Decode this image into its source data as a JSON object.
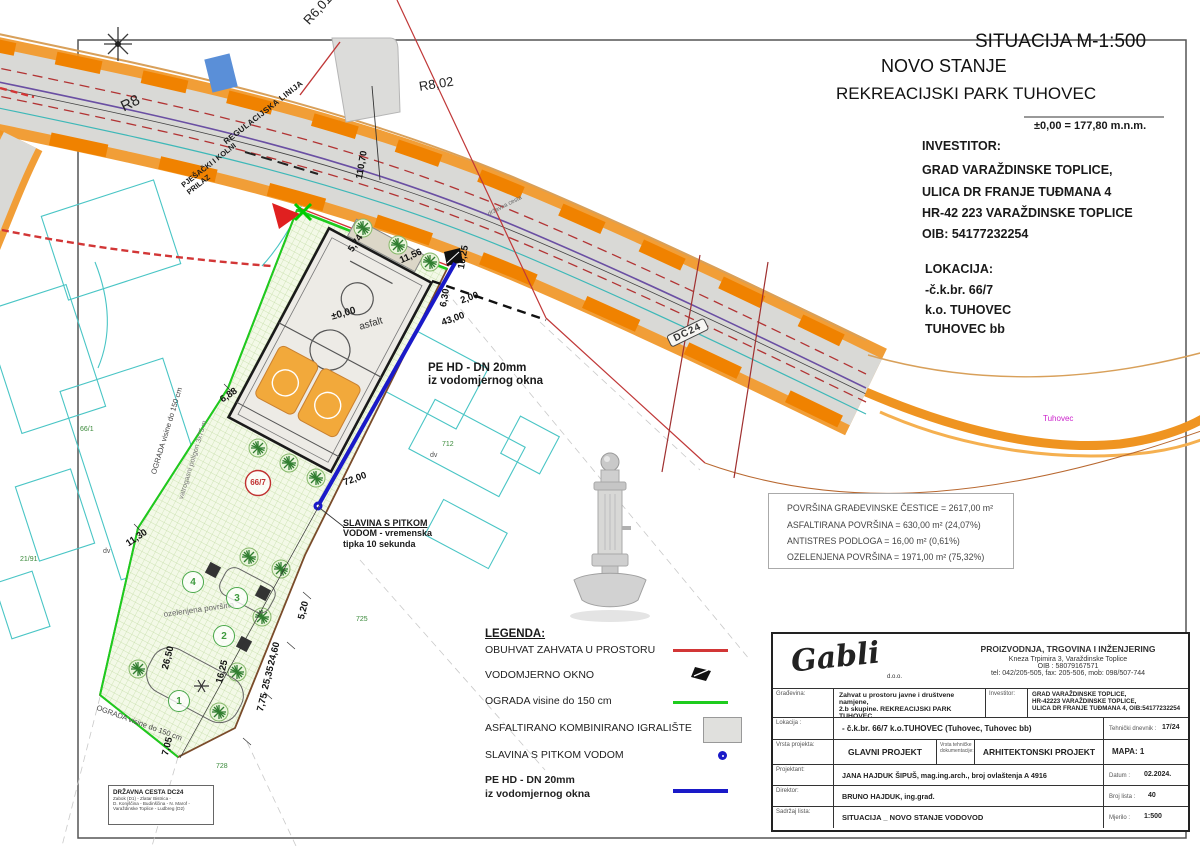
{
  "titles": {
    "situacija": "SITUACIJA  M-1:500",
    "novo_stanje": "NOVO STANJE",
    "park": "REKREACIJSKI PARK TUHOVEC",
    "elevation": "±0,00 = 177,80 m.n.m."
  },
  "investitor": {
    "label": "INVESTITOR:",
    "lines": [
      "GRAD VARAŽDINSKE TOPLICE,",
      "ULICA DR FRANJE TUĐMANA 4",
      " HR-42 223 VARAŽDINSKE TOPLICE",
      "OIB: 54177232254"
    ]
  },
  "lokacija": {
    "label": "LOKACIJA:",
    "lines": [
      "-č.k.br.  66/7",
      "k.o. TUHOVEC",
      "TUHOVEC bb"
    ]
  },
  "areas": {
    "lines": [
      "POVRŠINA GRAĐEVINSKE ČESTICE = 2617,00 m²",
      "ASFALTIRANA POVRŠINA = 630,00 m² (24,07%)",
      "ANTISTRES PODLOGA = 16,00 m² (0,61%)",
      "OZELENJENA POVRŠINA = 1971,00 m² (75,32%)"
    ]
  },
  "legend": {
    "title": "LEGENDA:",
    "items": [
      {
        "label": "OBUHVAT ZAHVATA U PROSTORU"
      },
      {
        "label": "VODOMJERNO OKNO"
      },
      {
        "label": "OGRADA visine do 150 cm"
      },
      {
        "label": "ASFALTIRANO KOMBINIRANO IGRALIŠTE"
      },
      {
        "label": "SLAVINA S PITKOM VODOM"
      },
      {
        "label": "PE HD - DN 20mm",
        "label2": "iz vodomjernog okna"
      }
    ]
  },
  "map": {
    "r8": "R8",
    "r601": "R6,01",
    "r802": "R8,02",
    "dc24_badge": "DC24",
    "tuhovec": "Tuhovec",
    "drzavna_cesta": "državna cesta",
    "regulacijska": "REGULACIJSKA LINIJA",
    "pjesacki": "PJEŠAČKI I KOLNI",
    "prilaz": "PRILAZ",
    "ograda_left": "OGRADA visine do 150 cm",
    "vatrogasni": "vatrogasni poligon 3x75 m",
    "ograda_bottom": "OGRADA visine do 150 cm",
    "ozelenjena": "ozelenjena površina",
    "zero": "±0,00",
    "asfalt": "asfalt",
    "pehd1": "PE HD - DN 20mm",
    "pehd2": "iz vodomjernog okna",
    "slavina1": "SLAVINA S PITKOM",
    "slavina2": "VODOM - vremenska",
    "slavina3": "tipka 10 sekunda",
    "parcel_main": "66/7",
    "zones": {
      "z1": "1",
      "z2": "2",
      "z3": "3",
      "z4": "4"
    },
    "parcels": {
      "p66_1": "66/1",
      "p21_91": "21/91",
      "p725": "725",
      "p712": "712",
      "p728": "728",
      "dv1": "dv",
      "dv2": "dv"
    },
    "dims": {
      "d110_70": "110,70",
      "d11_56": "11,56",
      "d5_74": "5,74",
      "d10_25": "10,25",
      "d6_30": "6,30",
      "d2_00": "2,00",
      "d43_00": "43,00",
      "d6_88": "6,88",
      "d11_30": "11,30",
      "d26_50": "26,50",
      "d16_25": "16,25",
      "d5_20": "5,20",
      "d24_60": "24,60",
      "d25_35": "25,35",
      "d7_75": "7,75",
      "d7_05": "7,05",
      "d72_00": "72,00"
    }
  },
  "roadbox": {
    "title": "DRŽAVNA CESTA DC24",
    "lines": [
      "Zabok (D1) - Zlatar Bistrica -",
      "D. Konjščina - Budinščina - N. Marof -",
      "Varaždinske Toplice - Ludbreg (D2)"
    ]
  },
  "titleblock": {
    "logo": "Gabli",
    "logo_suffix": "d.o.o.",
    "company": {
      "line1": "PROIZVODNJA, TRGOVINA I INŽENJERING",
      "line2": "Kneza Trpimira 3, Varaždinske Toplice",
      "line3": "OIB : 58079167571",
      "line4": "tel: 042/205-505, fax: 205-506, mob: 098/507-744"
    },
    "rows": {
      "gradevina_label": "Građevina:",
      "gradevina1": "Zahvat u prostoru javne i društvene namjene,",
      "gradevina2": "2.b skupine. REKREACIJSKI PARK TUHOVEC",
      "investitor_label": "Investitor:",
      "investitor1": "GRAD VARAŽDINSKE TOPLICE,",
      "investitor2": "HR-42223 VARAŽDINSKE TOPLICE,",
      "investitor3": "ULICA DR FRANJE TUĐMANA 4,  OIB:54177232254",
      "lokacija_label": "Lokacija :",
      "lokacija": "- č.k.br.  66/7  k.o.TUHOVEC (Tuhovec, Tuhovec bb)",
      "tehnicki_label": "Tehnički dnevnik :",
      "tehnicki": "17/24",
      "vrsta_label": "Vrsta projekta:",
      "vrsta": "GLAVNI PROJEKT",
      "vrsta_teh_label": "Vrsta tehničke dokumentacije:",
      "arh": "ARHITEKTONSKI PROJEKT",
      "mapa": "MAPA: 1",
      "projektant_label": "Projektant:",
      "projektant": "JANA HAJDUK ŠIPUŠ, mag.ing.arch.,  broj ovlaštenja A 4916",
      "datum_label": "Datum :",
      "datum": "02.2024.",
      "direktor_label": "Direktor:",
      "direktor": "BRUNO HAJDUK, ing.građ.",
      "broj_label": "Broj lista :",
      "broj": "40",
      "sadrzaj_label": "Sadržaj lista:",
      "sadrzaj": "SITUACIJA _ NOVO STANJE   VODOVOD",
      "mjerilo_label": "Mjerilo :",
      "mjerilo": "1:500"
    }
  },
  "colors": {
    "obuhvat_red": "#d23636",
    "ograda_green": "#1ecc1e",
    "pipe_blue": "#1a1ac8",
    "road_edge_orange": "#ef9421",
    "hatch_green": "#c2dca4",
    "tuhovec_magenta": "#cc22cc"
  }
}
